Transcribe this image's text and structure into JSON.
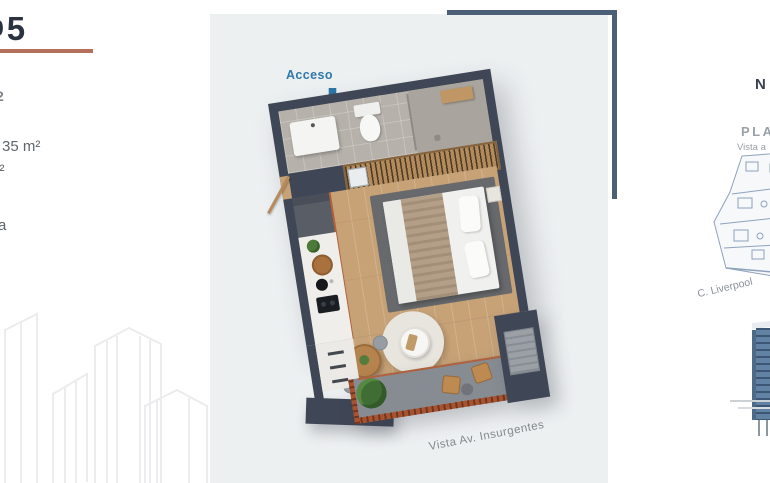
{
  "left_panel": {
    "title_prefix": "0",
    "title_digit": "5",
    "fragment_level": "2",
    "area_interior": "35 m²",
    "fragment_m2": "m²",
    "fragment_a": "a",
    "accent_color": "#b5705c"
  },
  "plan_panel": {
    "access_label": "Acceso",
    "street_label": "Vista Av. Insurgentes",
    "colors": {
      "panel_bg": "#edf0f1",
      "frame": "#4b5f76",
      "wall": "#3f4655",
      "wood_floor": "#c7a277",
      "bath_tile": "#b6b1aa",
      "rug": "#67696c",
      "balcony_rail": "#a8532f",
      "access_blue": "#2b77aa"
    }
  },
  "right_panel": {
    "compass": "N",
    "plan_label": "PLAN",
    "vista_label": "Vista a",
    "street_label": "C. Liverpool",
    "tower_color": "#6282a4"
  }
}
